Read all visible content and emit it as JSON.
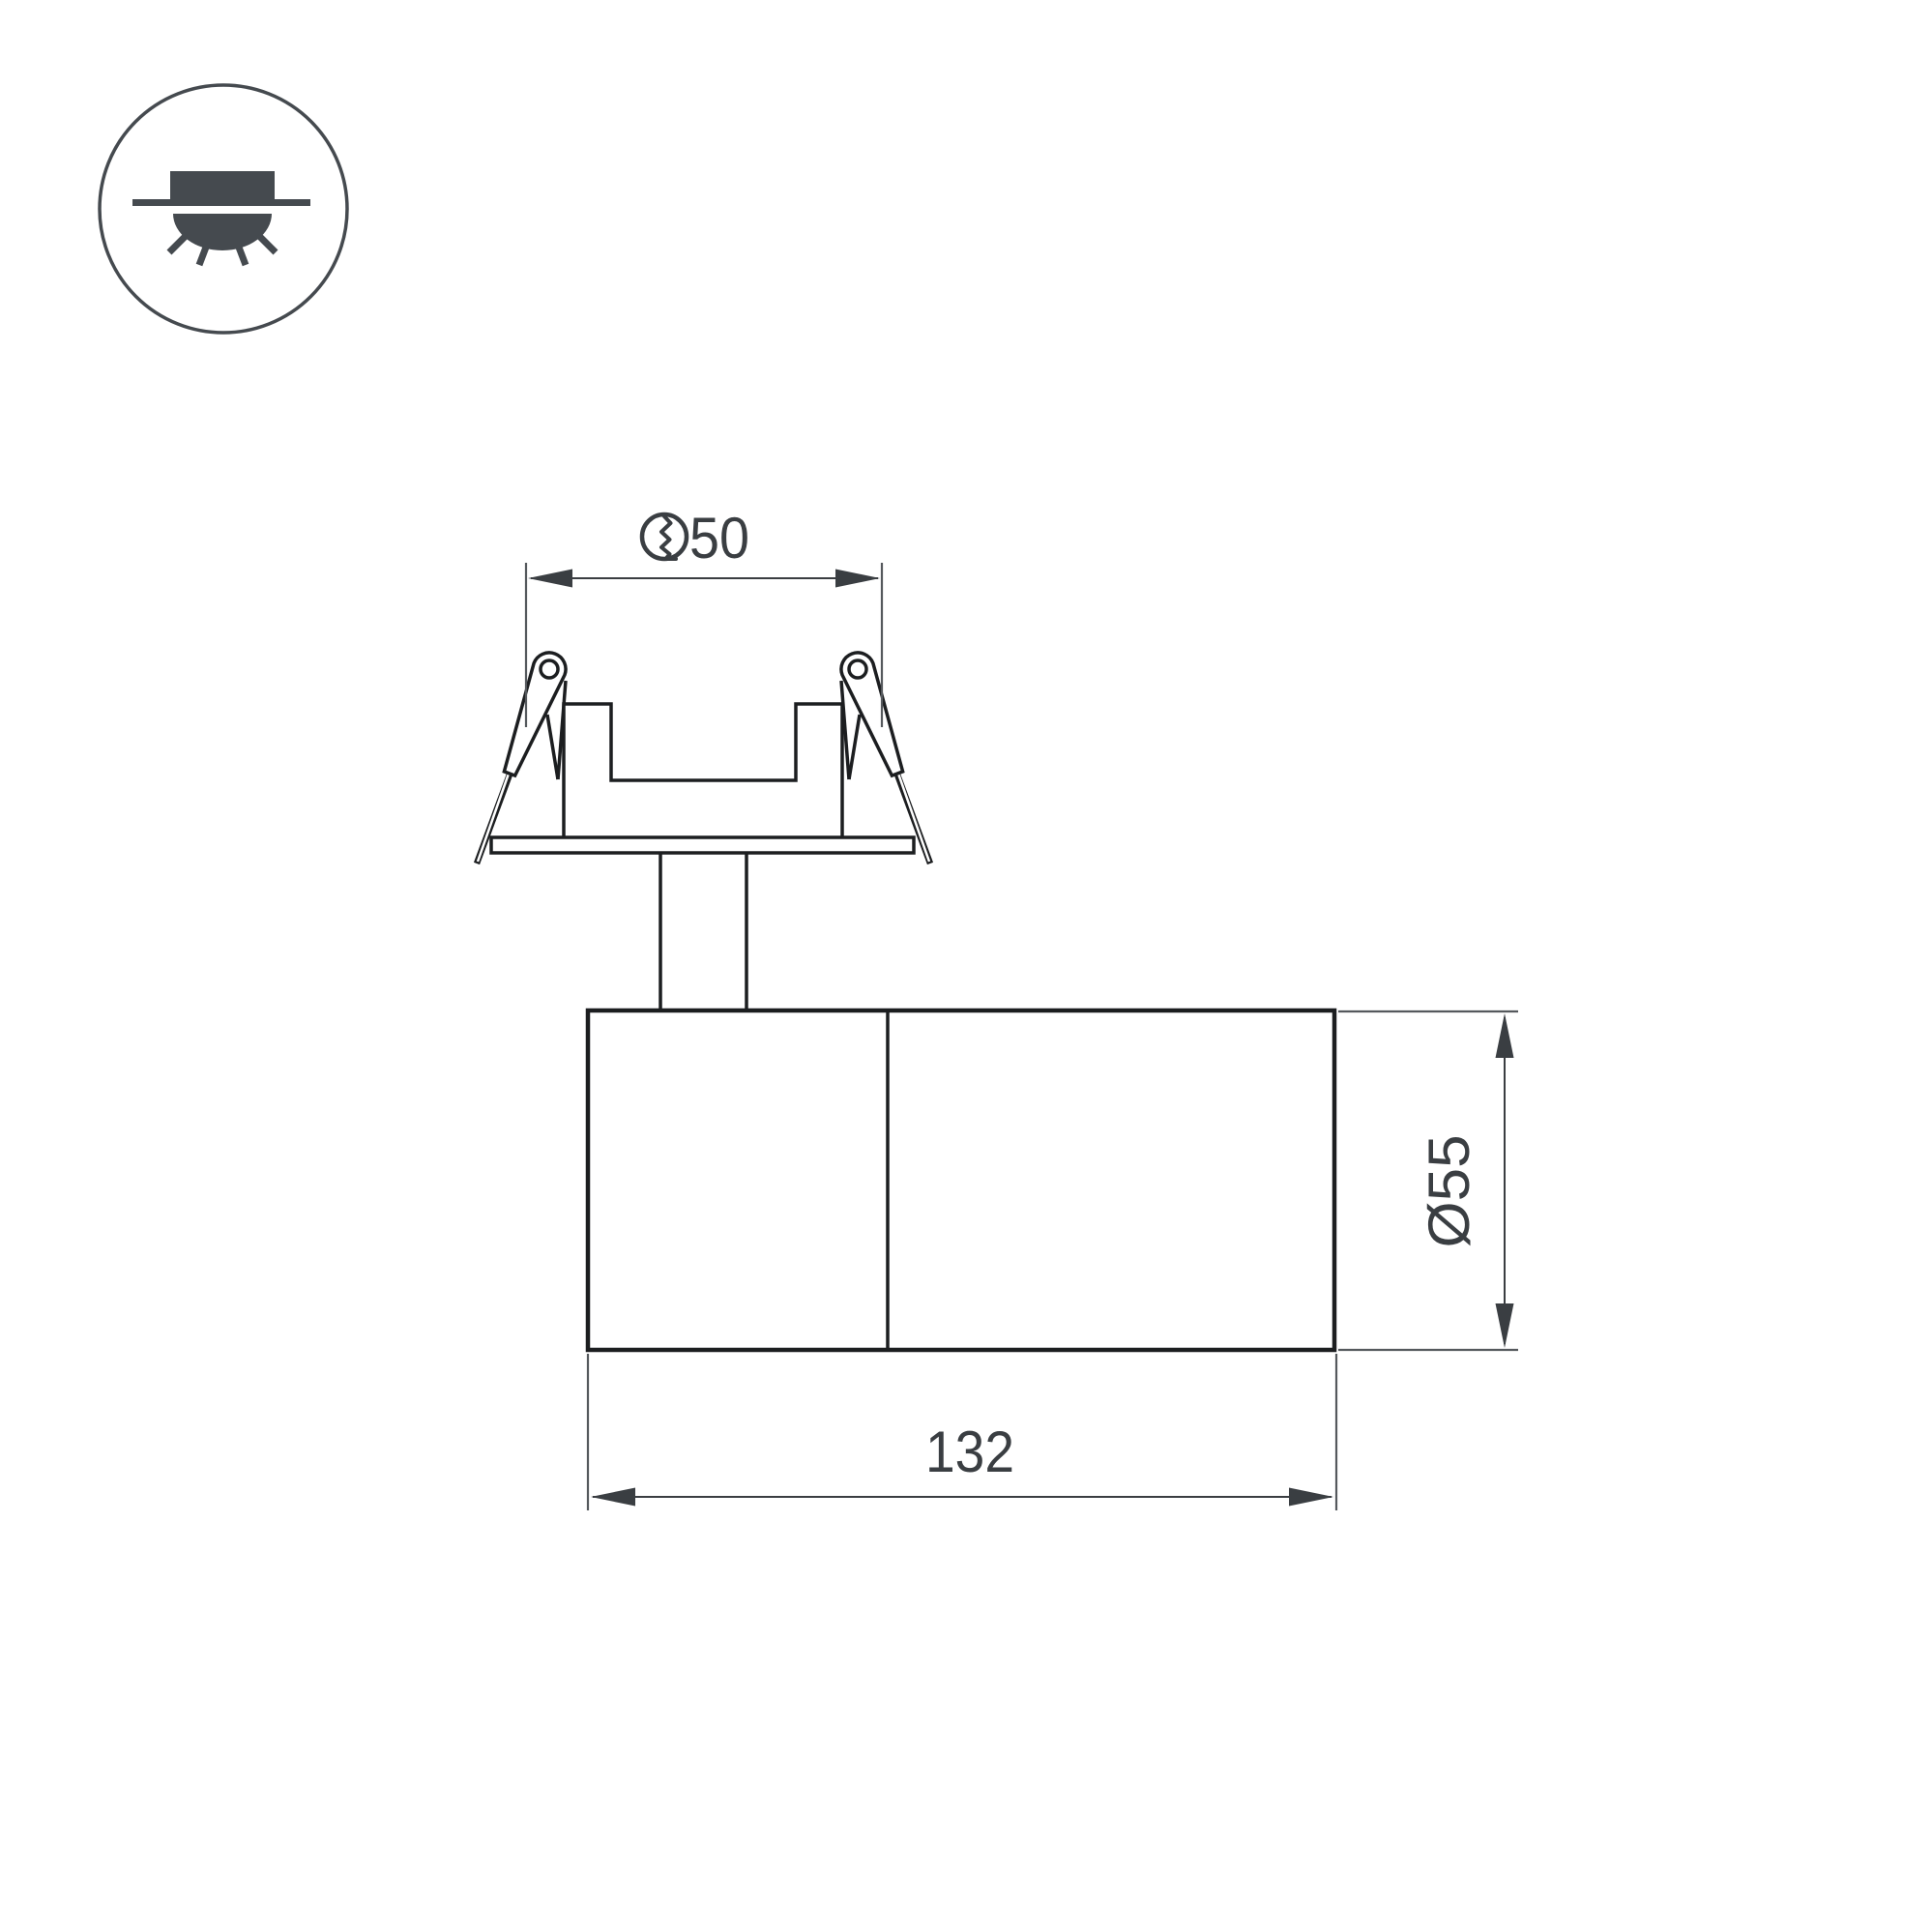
{
  "page": {
    "type": "technical-dimension-drawing",
    "subject": "recessed-spot-luminaire"
  },
  "legend": {
    "icon": "recessed-downlight-icon",
    "meaning": "recessed ceiling mount luminaire"
  },
  "dimensions": {
    "hole": {
      "symbol": "cut-hole-diameter-icon",
      "value": "50"
    },
    "body_diameter": {
      "value": "Ø55"
    },
    "body_length": {
      "value": "132"
    }
  },
  "colors": {
    "outline": "#1c1e20",
    "dimension": "#3a3e42",
    "extension": "#55595d",
    "icon": "#454a4f",
    "background": "#ffffff"
  }
}
